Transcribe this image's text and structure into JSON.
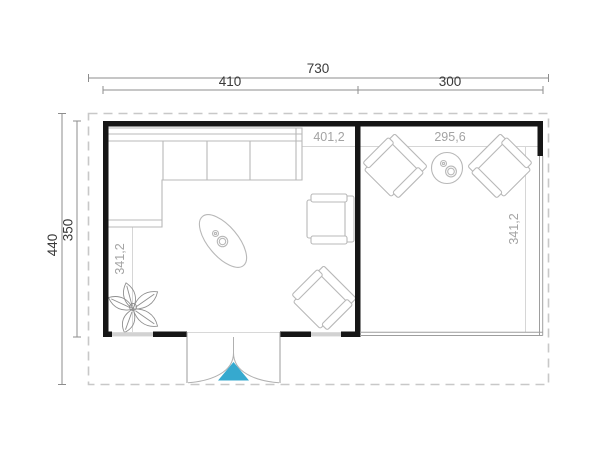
{
  "plan": {
    "dimensions": {
      "overall_width": "730",
      "main_section_width": "410",
      "annex_section_width": "300",
      "overall_depth": "440",
      "building_depth": "350"
    },
    "interior_dimensions": {
      "left_room_width": "401,2",
      "left_room_depth": "341,2",
      "right_room_width": "295,6",
      "right_room_depth": "341,2"
    },
    "colors": {
      "wall": "#161616",
      "outer_dimension_line": "#8d8d8d",
      "outer_dimension_text": "#3a3a3a",
      "interior_dimension_line": "#d0d0d0",
      "interior_dimension_text": "#a3a3a3",
      "furniture_line": "#b8b8b8",
      "roof_dash": "#c8c8c8",
      "open_edge": "#9e9e9e",
      "window": "#d2d2d2",
      "door_line": "#b0b0b0",
      "door_accent": "#36a9cf"
    }
  }
}
